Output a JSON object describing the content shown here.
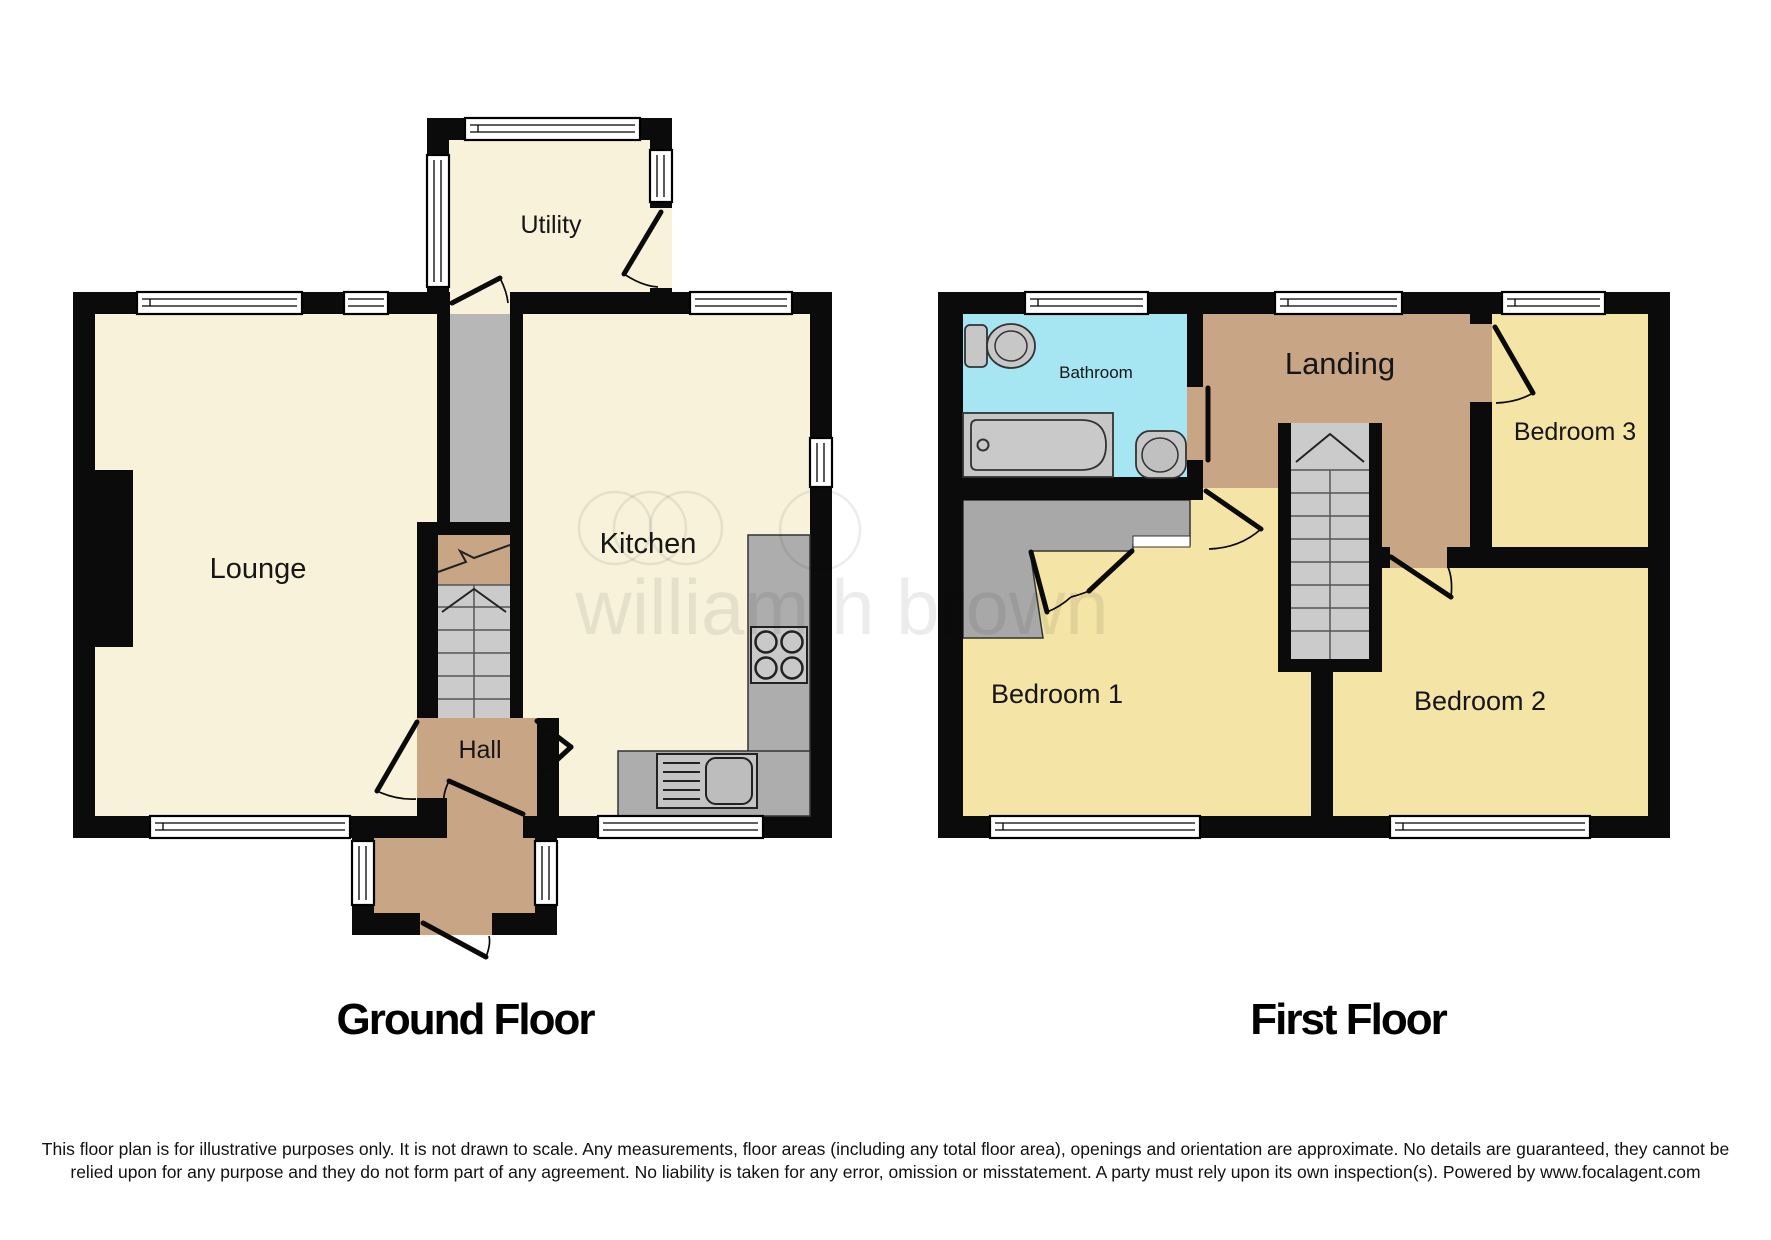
{
  "watermark": {
    "brand": "william h brown"
  },
  "ground_floor": {
    "title": "Ground Floor",
    "rooms": {
      "utility": "Utility",
      "lounge": "Lounge",
      "kitchen": "Kitchen",
      "hall": "Hall"
    }
  },
  "first_floor": {
    "title": "First Floor",
    "rooms": {
      "bathroom": "Bathroom",
      "landing": "Landing",
      "bedroom1": "Bedroom 1",
      "bedroom2": "Bedroom 2",
      "bedroom3": "Bedroom 3"
    }
  },
  "footer": {
    "disclaimer": "This floor plan is for illustrative purposes only. It is not drawn to scale. Any measurements, floor areas (including any total floor area), openings and orientation are approximate. No details are guaranteed, they cannot be relied upon for any purpose and they do not form part of any agreement. No liability is taken for any error, omission or misstatement. A party must rely upon its own inspection(s). Powered by www.focalagent.com"
  },
  "colors": {
    "floor-cream": "#F8F2DB",
    "floor-yellow": "#F4E4A5",
    "floor-tan": "#C8A585",
    "floor-cyan": "#A6E6F3",
    "wall": "#0B0B0B",
    "stair-gray": "#B7B7B7",
    "step-gray": "#CBCBCB",
    "counter-gray": "#ADADAD",
    "fixture-gray": "#C7C7C7",
    "wardrobe-gray": "#A8A8A8"
  }
}
